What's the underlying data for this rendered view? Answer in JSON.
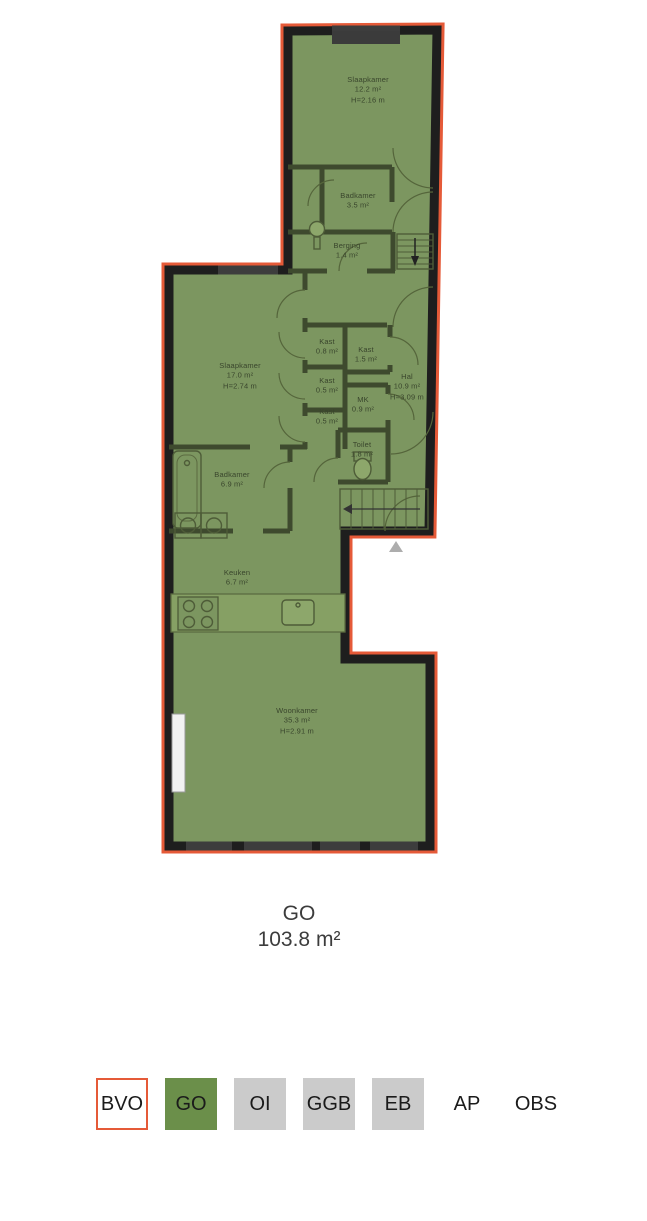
{
  "floor_plan": {
    "caption": {
      "label": "GO",
      "area": "103.8 m²"
    },
    "rooms": [
      {
        "id": "slaapkamer-boven",
        "lines": [
          "Slaapkamer",
          "12.2 m²",
          "H=2.16 m"
        ],
        "x": 368,
        "y": 82
      },
      {
        "id": "badkamer-boven",
        "lines": [
          "Badkamer",
          "3.5 m²"
        ],
        "x": 358,
        "y": 198
      },
      {
        "id": "berging",
        "lines": [
          "Berging",
          "1.4 m²"
        ],
        "x": 347,
        "y": 248
      },
      {
        "id": "slaapkamer",
        "lines": [
          "Slaapkamer",
          "17.0 m²",
          "H=2.74 m"
        ],
        "x": 240,
        "y": 368
      },
      {
        "id": "kast-1",
        "lines": [
          "Kast",
          "0.8 m²"
        ],
        "x": 327,
        "y": 344
      },
      {
        "id": "kast-2",
        "lines": [
          "Kast",
          "1.5 m²"
        ],
        "x": 366,
        "y": 352
      },
      {
        "id": "kast-3",
        "lines": [
          "Kast",
          "0.5 m²"
        ],
        "x": 327,
        "y": 383
      },
      {
        "id": "kast-4",
        "lines": [
          "Kast",
          "0.5 m²"
        ],
        "x": 327,
        "y": 414
      },
      {
        "id": "hal",
        "lines": [
          "Hal",
          "10.9 m²",
          "H=3.09 m"
        ],
        "x": 407,
        "y": 379
      },
      {
        "id": "mk",
        "lines": [
          "MK",
          "0.9 m²"
        ],
        "x": 363,
        "y": 402
      },
      {
        "id": "toilet",
        "lines": [
          "Toilet",
          "1.8 m²"
        ],
        "x": 362,
        "y": 447
      },
      {
        "id": "badkamer",
        "lines": [
          "Badkamer",
          "6.9 m²"
        ],
        "x": 232,
        "y": 477
      },
      {
        "id": "keuken",
        "lines": [
          "Keuken",
          "6.7 m²"
        ],
        "x": 237,
        "y": 575
      },
      {
        "id": "woonkamer",
        "lines": [
          "Woonkamer",
          "35.3 m²",
          "H=2.91 m"
        ],
        "x": 297,
        "y": 713
      }
    ],
    "colors": {
      "surface": "#7C9660",
      "outline": "#E55A38",
      "wall": "#1E1E1E",
      "interior_wall": "#3E4A2E",
      "window": "#3D3D3D"
    }
  },
  "legend": {
    "items": [
      {
        "label": "BVO",
        "style": "outlined"
      },
      {
        "label": "GO",
        "style": "filled-green"
      },
      {
        "label": "OI",
        "style": "filled-gray"
      },
      {
        "label": "GGB",
        "style": "filled-gray"
      },
      {
        "label": "EB",
        "style": "filled-gray"
      },
      {
        "label": "AP",
        "style": "plain"
      },
      {
        "label": "OBS",
        "style": "plain"
      }
    ],
    "colors": {
      "green": "#6B8F4A",
      "gray": "#CBCBCB",
      "outline": "#E55A38"
    }
  }
}
